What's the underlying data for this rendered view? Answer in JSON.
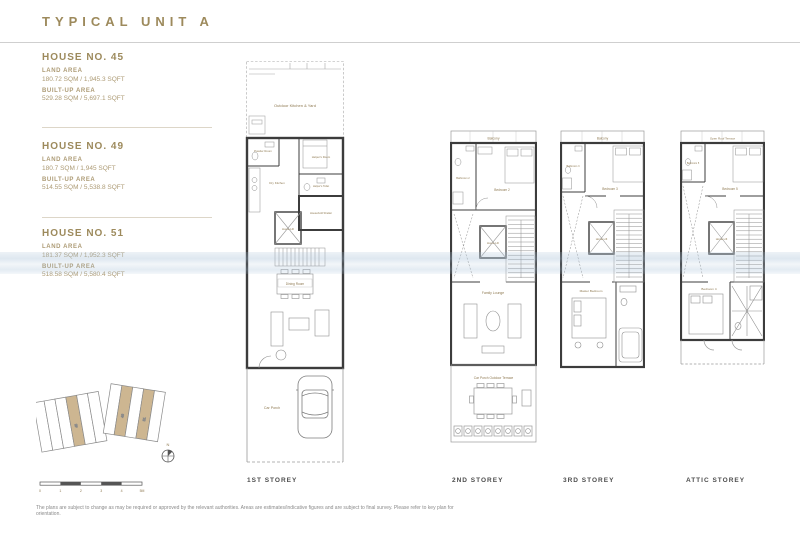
{
  "page": {
    "title": "TYPICAL UNIT A",
    "disclaimer": "The plans are subject to change as may be required or approved by the relevant authorities. Areas are estimates/indicative figures and are subject to final survey. Please refer to key plan for orientation."
  },
  "houses": [
    {
      "name": "HOUSE NO. 45",
      "land_label": "LAND AREA",
      "land_value": "180.72 SQM / 1,945.3 SQFT",
      "built_label": "BUILT-UP AREA",
      "built_value": "529.28 SQM / 5,697.1 SQFT"
    },
    {
      "name": "HOUSE NO. 49",
      "land_label": "LAND AREA",
      "land_value": "180.7 SQM / 1,945 SQFT",
      "built_label": "BUILT-UP AREA",
      "built_value": "514.55 SQM / 5,538.8 SQFT"
    },
    {
      "name": "HOUSE NO. 51",
      "land_label": "LAND AREA",
      "land_value": "181.37 SQM / 1,952.3 SQFT",
      "built_label": "BUILT-UP AREA",
      "built_value": "518.58 SQM / 5,580.4 SQFT"
    }
  ],
  "floors": [
    {
      "label": "1ST STOREY",
      "rooms": [
        "Outdoor Kitchen & Yard",
        "Powder Room",
        "Helper's Room",
        "Helper's Toilet",
        "Dry Kitchen",
        "Household Shelter",
        "Home Lift",
        "Dining Room",
        "Car Porch"
      ]
    },
    {
      "label": "2ND STOREY",
      "rooms": [
        "Balcony",
        "Bathroom 2",
        "Bedroom 2",
        "Home Lift",
        "Family Lounge",
        "Car Porch Outdoor Terrace"
      ]
    },
    {
      "label": "3RD STOREY",
      "rooms": [
        "Balcony",
        "Bathroom 3",
        "Bedroom 3",
        "Home Lift",
        "Master Bedroom"
      ]
    },
    {
      "label": "ATTIC STOREY",
      "rooms": [
        "Open Roof Terrace",
        "Bathroom 5",
        "Bedroom 5",
        "Home Lift",
        "Bedroom 4"
      ]
    }
  ],
  "key_plan": {
    "north": "N",
    "highlighted": [
      "45",
      "49",
      "51"
    ],
    "scale": [
      "0",
      "1",
      "2",
      "3",
      "4",
      "5M"
    ]
  }
}
